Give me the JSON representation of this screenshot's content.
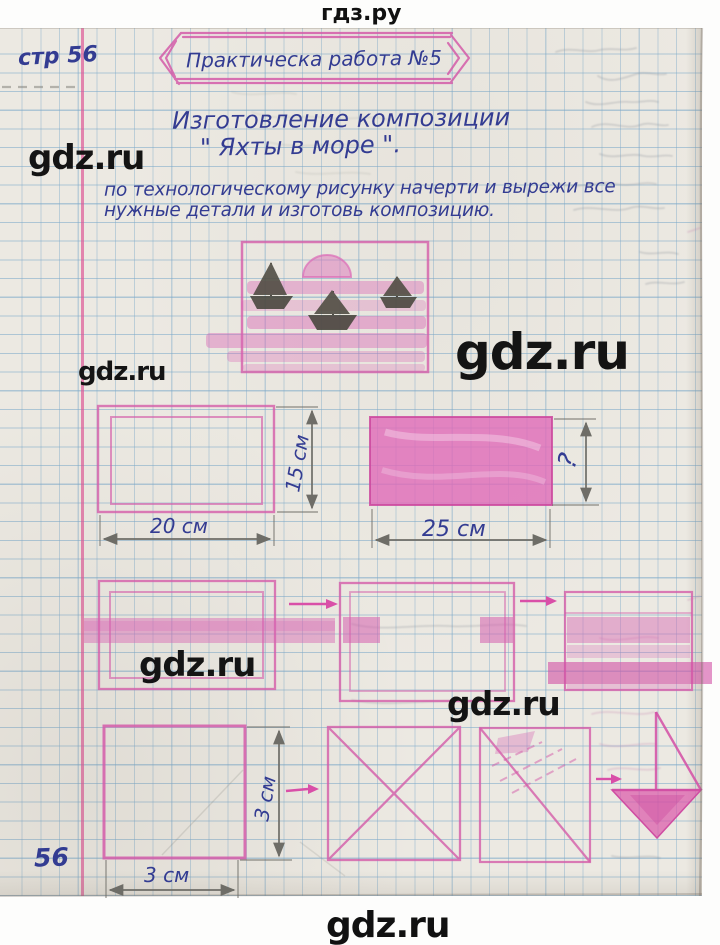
{
  "site": {
    "header_brand": "гдз.ру",
    "footer_brand": "gdz.ru",
    "watermark": "gdz.ru"
  },
  "notebook": {
    "corner_page_label": "стр 56",
    "bottom_page_number": "56",
    "banner_title": "Практическа работа №5",
    "heading_line1": "Изготовление композиции",
    "heading_line2": "\" Яхты в море \".",
    "task_line1": "по технологическому рисунку начерти и вырежи все",
    "task_line2": "нужные детали и изготовь композицию.",
    "dimensions": {
      "sheet1_width": "20 см",
      "sheet1_height": "15 см",
      "sheet2_width": "25 см",
      "sheet2_height": "?",
      "square_width": "3 см",
      "square_height": "3 см"
    }
  },
  "colors": {
    "pink_pencil": "#d45ca9",
    "ink_blue": "#333c92",
    "grid_blue": "#7aa8c9",
    "margin_pink": "#dd5493",
    "pencil_gray": "#6e6d67",
    "boat_gray": "#4a483f",
    "watermark_black": "#141414",
    "paper": "#ece9e2"
  }
}
